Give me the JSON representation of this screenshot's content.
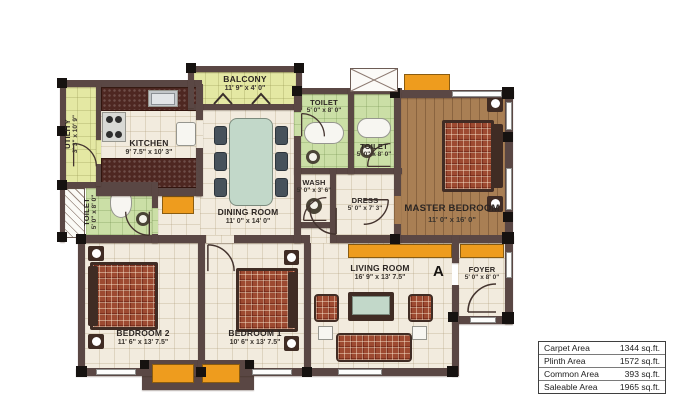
{
  "rooms": {
    "utility": {
      "name": "UTILITY",
      "dims": "3' 3\" x 10' 9\""
    },
    "kitchen": {
      "name": "KITCHEN",
      "dims": "9' 7.5\" x 10' 3\""
    },
    "balcony": {
      "name": "BALCONY",
      "dims": "11' 9\" x 4' 0\""
    },
    "toilet_a": {
      "name": "TOILET",
      "dims": "5' 0\" x 8' 0\""
    },
    "toilet_b": {
      "name": "TOILET",
      "dims": "5' 0\" x 8' 0\""
    },
    "toilet_c": {
      "name": "TOILET",
      "dims": "5' 0\" x 8' 0\""
    },
    "wash": {
      "name": "WASH",
      "dims": "5' 0\" x 3' 6\""
    },
    "dress": {
      "name": "DRESS",
      "dims": "5' 0\" x 7' 3\""
    },
    "dining": {
      "name": "DINING ROOM",
      "dims": "11' 0\" x 14' 0\""
    },
    "master": {
      "name": "MASTER BEDROOM",
      "dims": "11' 0\" x 16' 0\""
    },
    "bedroom2": {
      "name": "BEDROOM 2",
      "dims": "11' 6\" x 13' 7.5\""
    },
    "bedroom1": {
      "name": "BEDROOM 1",
      "dims": "10' 6\" x 13' 7.5\""
    },
    "living": {
      "name": "LIVING ROOM",
      "dims": "16' 9\" x 13' 7.5\""
    },
    "foyer": {
      "name": "FOYER",
      "dims": "5' 0\" x 8' 0\""
    }
  },
  "marker": {
    "label": "A"
  },
  "area_table": {
    "rows": [
      {
        "label": "Carpet Area",
        "value": "1344 sq.ft."
      },
      {
        "label": "Plinth Area",
        "value": "1572 sq.ft."
      },
      {
        "label": "Common Area",
        "value": "393 sq.ft."
      },
      {
        "label": "Saleable Area",
        "value": "1965 sq.ft."
      }
    ]
  },
  "palette": {
    "wall": "#5a4744",
    "floor_tile": "#f2ebde",
    "toilet_green": "#cbdfa6",
    "utility_green": "#e4e8a3",
    "accent_orange": "#ee9c1e",
    "wood_floor": "#a97f54",
    "fabric_plaid": "#9d4a31"
  }
}
